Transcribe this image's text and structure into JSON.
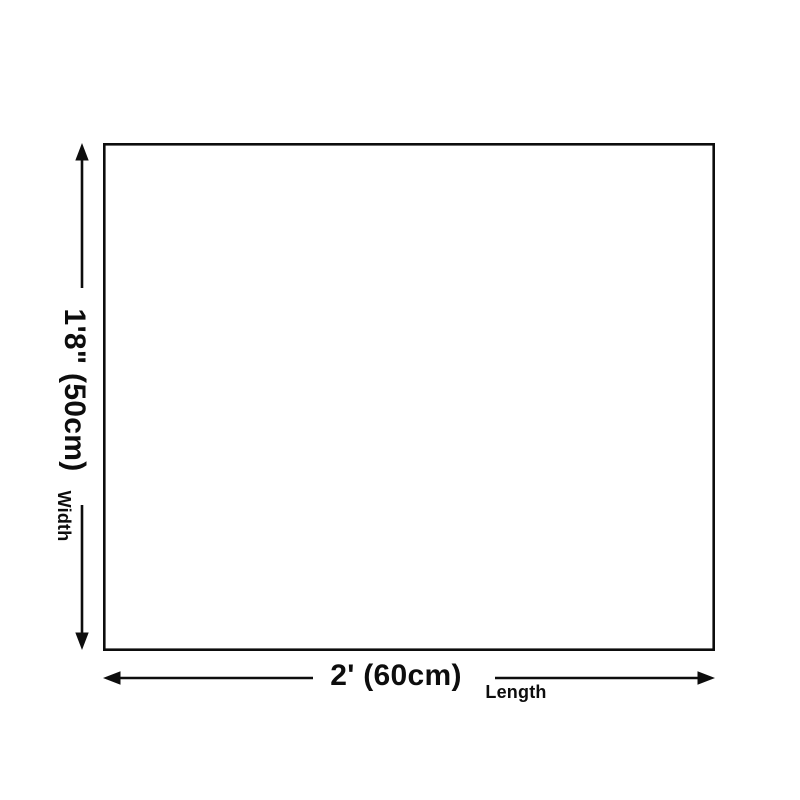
{
  "diagram": {
    "line_color": "#0d0d0d",
    "background_color": "#ffffff",
    "vertical_dimension": {
      "value": "1'8\" (50cm)",
      "axis_label": "Width"
    },
    "horizontal_dimension": {
      "value": "2' (60cm)",
      "axis_label": "Length"
    }
  }
}
